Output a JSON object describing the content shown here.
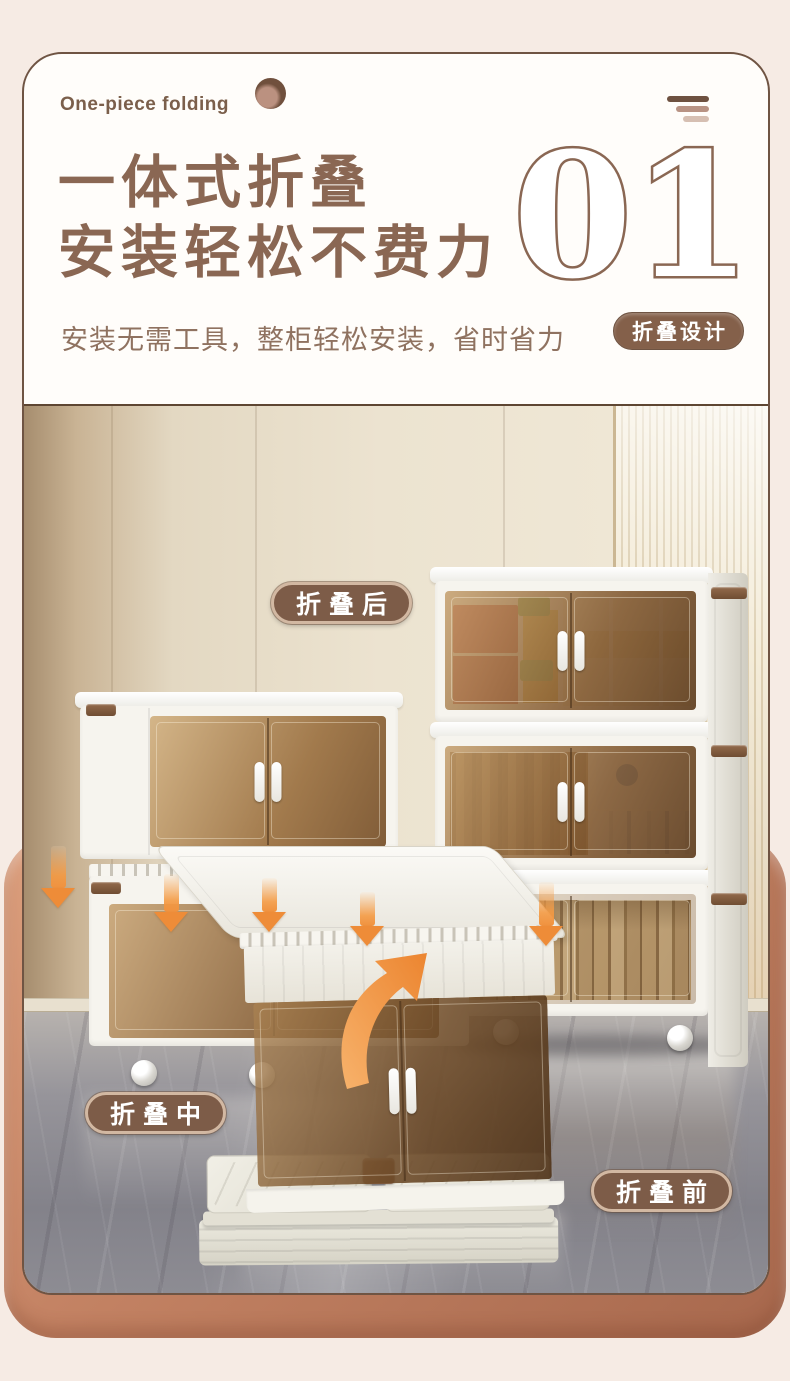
{
  "header": {
    "eyebrow": "One-piece folding",
    "title_line1": "一体式折叠",
    "title_line2": "安装轻松不费力",
    "section_number": "01",
    "subtitle": "安装无需工具，整柜轻松安装，省时省力",
    "badge_label": "折叠设计"
  },
  "photo": {
    "label_folded_state": "折叠后",
    "label_folding_state": "折叠中",
    "label_unfolded_state": "折叠前"
  },
  "icons": {
    "brand_dot": "sphere-dot-icon",
    "menu_lines": "triple-lines-icon",
    "down_arrow": "fold-down-arrow-icon",
    "curved_arrow": "unfold-curve-arrow-icon"
  },
  "colors": {
    "page_background": "#f6ebe4",
    "accent_brown": "#8a6753",
    "card_border": "#6f5443",
    "terracotta_frame": "#b5755a",
    "label_background": "#7d5c48",
    "badge_background": "#84604a",
    "arrow_orange": "#f0923f",
    "glass_amber": "#8a6134"
  }
}
